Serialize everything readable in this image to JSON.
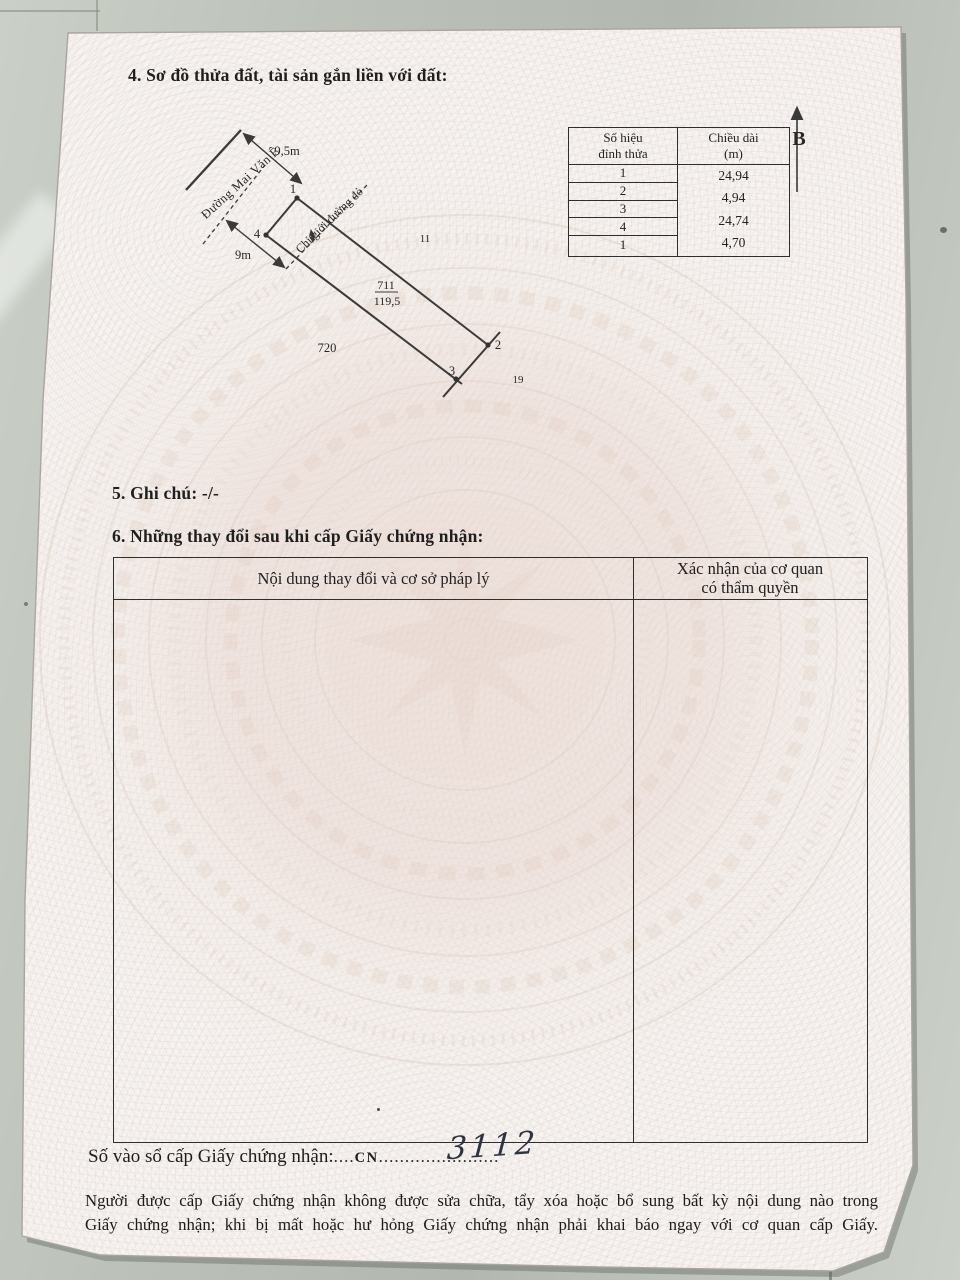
{
  "document": {
    "section4_title": "4. Sơ đồ thửa đất, tài sản gắn liền với đất:",
    "section5_title": "5. Ghi chú: -/-",
    "section6_title": "6. Những thay đổi sau khi cấp Giấy chứng nhận:",
    "registry_label": "Số vào sổ cấp Giấy chứng nhận:",
    "registry_dots1": "....",
    "registry_code": "CN",
    "registry_dots2": "........",
    "registry_number_handwritten": "3112",
    "registry_dots3": "...............",
    "footer_line1": "Người được cấp Giấy chứng nhận không được sửa chữa, tẩy xóa hoặc bổ sung bất kỳ nội dung nào trong",
    "footer_line2": "Giấy chứng nhận; khi bị mất hoặc hư hỏng Giấy chứng nhận phải khai báo ngay với cơ quan cấp Giấy."
  },
  "diagram": {
    "north_label": "B",
    "road_name": "Đường Mai Văn Ê",
    "red_boundary_label": "Chỉ giới đường đỏ",
    "dim_road_width_top": "9,5m",
    "dim_road_width_bottom": "9m",
    "parcel_number": "711",
    "parcel_area": "119,5",
    "adjacent_parcel_left": "720",
    "adjacent_parcel_right": "11",
    "adjacent_parcel_bottom": "19",
    "vertex_labels": [
      "1",
      "2",
      "3",
      "4"
    ]
  },
  "vertex_table": {
    "col1_header_line1": "Số hiệu",
    "col1_header_line2": "đỉnh thửa",
    "col2_header_line1": "Chiều dài",
    "col2_header_line2": "(m)",
    "vertex_ids": [
      "1",
      "2",
      "3",
      "4",
      "1"
    ],
    "lengths": [
      "24,94",
      "4,94",
      "24,74",
      "4,70"
    ]
  },
  "changes_table": {
    "col1_header": "Nội dung thay đổi và cơ sở pháp lý",
    "col2_header_line1": "Xác nhận của cơ quan",
    "col2_header_line2": "có thẩm quyền"
  },
  "colors": {
    "tile": "#bcc2b9",
    "paper": "#f6f3f0",
    "watermark": "#e3d6cd",
    "ink": "#2a2a2a"
  }
}
